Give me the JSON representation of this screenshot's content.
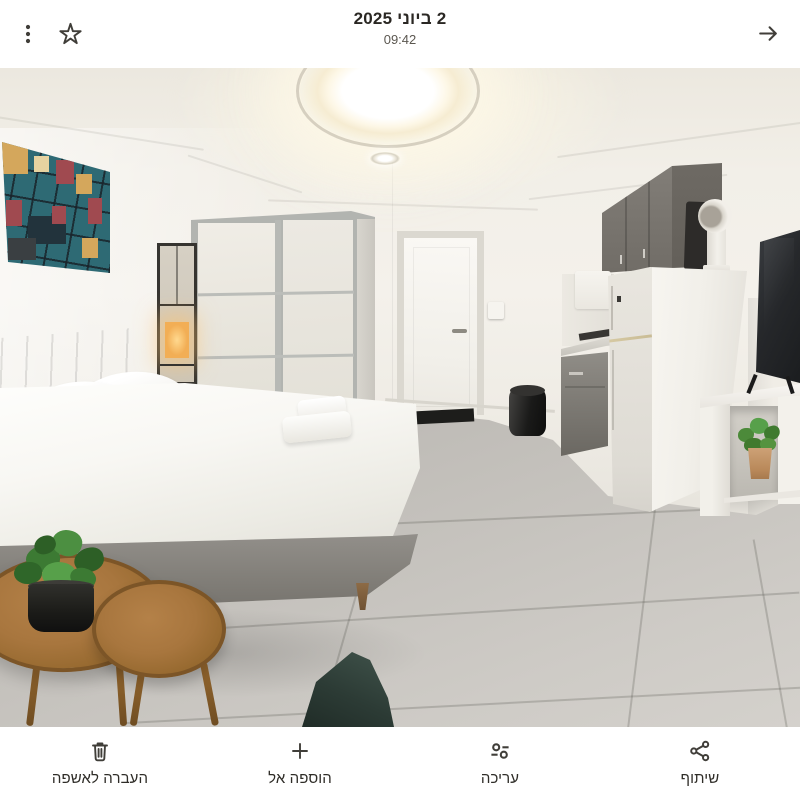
{
  "top_bar": {
    "more_options_icon": "kebab-menu",
    "favorite_icon": "star-outline",
    "date": "2 ביוני 2025",
    "time": "09:42",
    "back_icon": "arrow-right"
  },
  "photo": {
    "description": "Bright studio apartment: double bed with white linens and two folded towels, gray upholstered headboard, abstract teal wall art, frame floor lamp, white sliding-door wardrobe, white interior door, gray kitchenette with white refrigerator and vent, wall TV over a white shelf with a potted plant, round wooden nesting coffee tables with a plant, dark green floor cushion, round ceiling light, gray tile floor"
  },
  "bottom_bar": {
    "actions": [
      {
        "id": "trash",
        "icon": "trash",
        "label": "העברה לאשפה"
      },
      {
        "id": "add-to",
        "icon": "plus",
        "label": "הוספה אל"
      },
      {
        "id": "edit",
        "icon": "tune-sliders",
        "label": "עריכה"
      },
      {
        "id": "share",
        "icon": "share",
        "label": "שיתוף"
      }
    ]
  }
}
